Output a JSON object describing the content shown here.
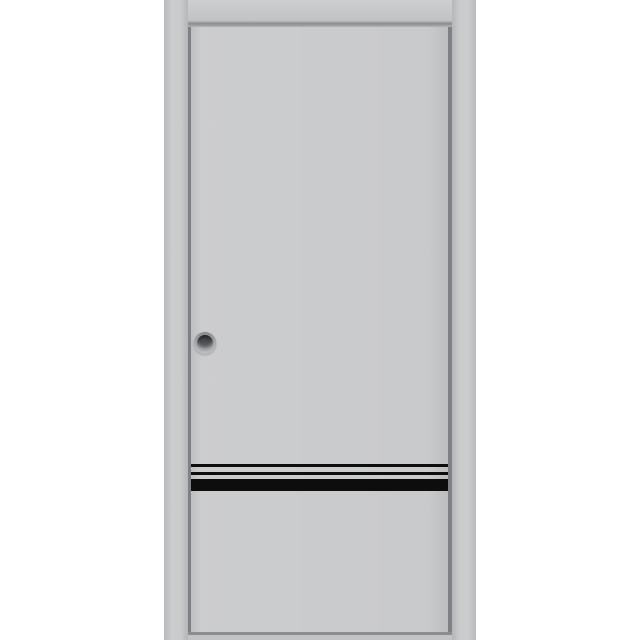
{
  "image": {
    "kind": "product-photo",
    "subject": "Gray pocket sliding door in frame with round recessed pull and three black horizontal inlay stripes near the bottom",
    "background_color": "#ffffff"
  },
  "frame": {
    "left_jamb_label": "left frame jamb",
    "right_jamb_label": "right frame jamb",
    "header_label": "frame header bar",
    "track_label": "bottom track strip",
    "jamb_color": "#c6c7c9",
    "header_color": "#c8c9cb",
    "track_color": "#c2c3c5",
    "reveal_shadow_color": "#8b8d90"
  },
  "door": {
    "label": "door leaf",
    "face_color": "#c9cacc",
    "edge_color": "#7e8083",
    "handle": {
      "label": "round recessed pull",
      "rim_color": "#a9abad",
      "cup_dark_color": "#36383b",
      "cup_light_color": "#77797c"
    },
    "stripes": {
      "color": "#0d0d0d",
      "items": [
        {
          "name": "thin inlay stripe 1",
          "height_px": 3
        },
        {
          "name": "thin inlay stripe 2",
          "height_px": 3
        },
        {
          "name": "thick inlay stripe",
          "height_px": 12
        }
      ]
    }
  }
}
